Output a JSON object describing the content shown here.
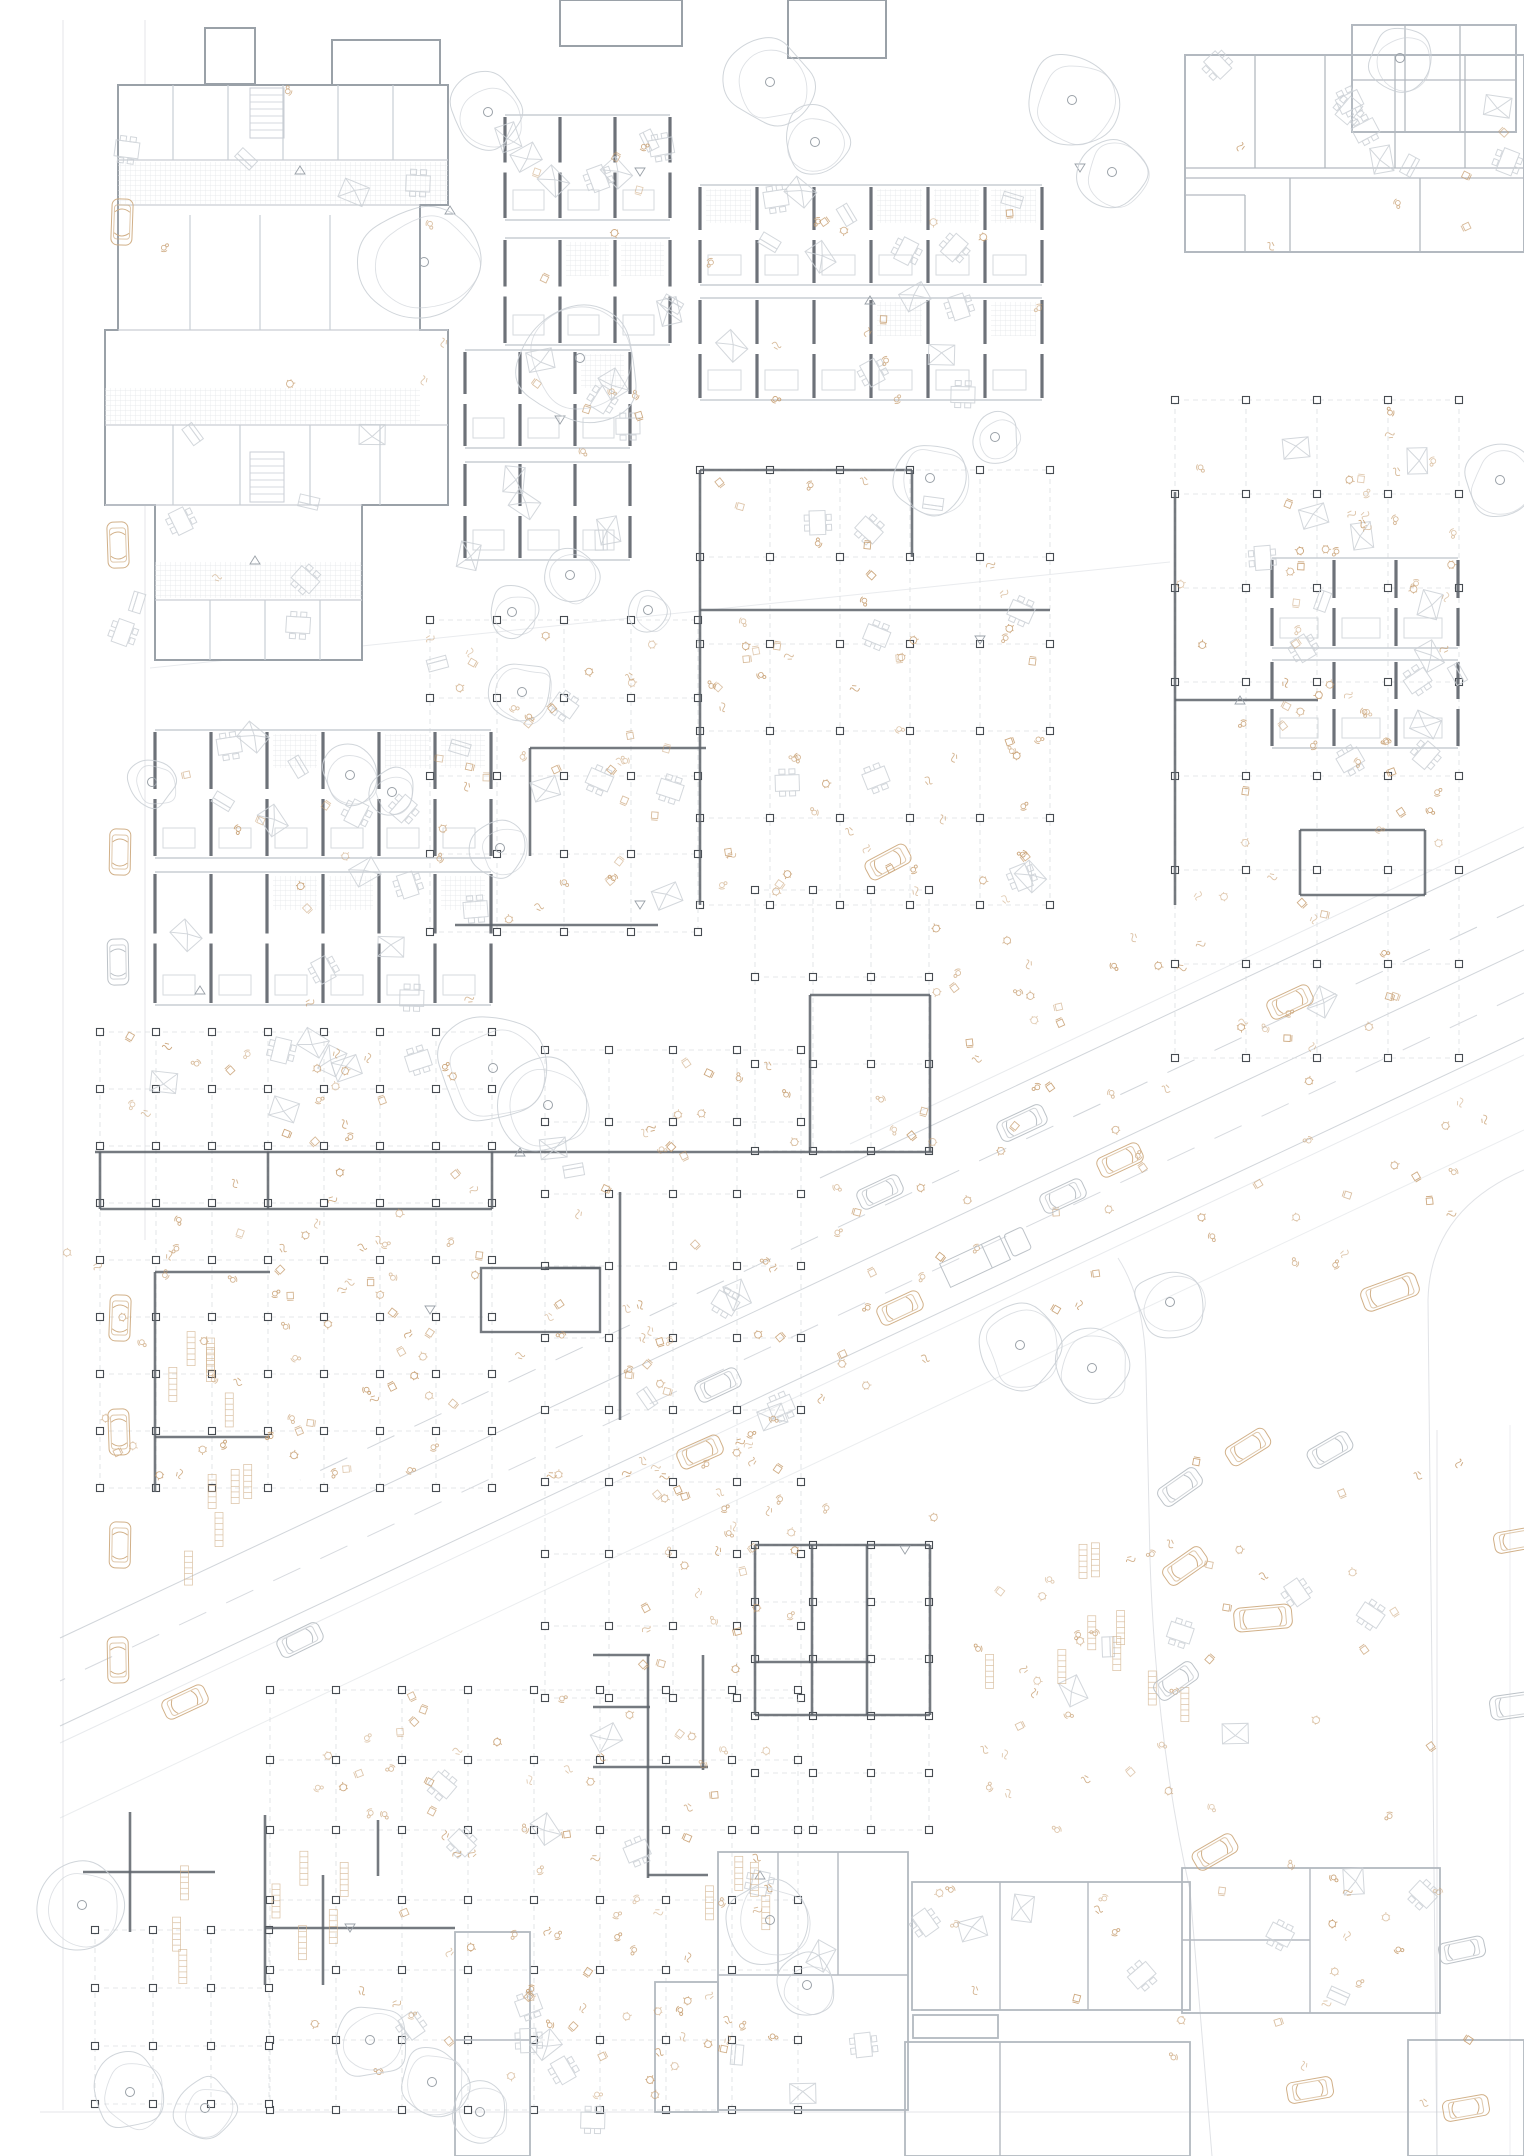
{
  "canvas": {
    "w": 1524,
    "h": 2156,
    "bg": "#ffffff"
  },
  "colors": {
    "wall_light": "#b3b9c0",
    "wall_mid": "#9aa1a8",
    "wall_dark": "#5d636a",
    "column": "#474c52",
    "line_light": "#c9ced4",
    "grid_dash": "#d8dbdf",
    "hatch": "#e2e5e9",
    "tree": "#cbd0d6",
    "beige": "#c69c6d",
    "beige_light": "#d1b18b",
    "car_tan": "#cfac82",
    "car_gray": "#b9bfc5",
    "road": "#c6cbd1",
    "furn_gray": "#ccd1d6"
  },
  "seed": 7,
  "faint_lines": [
    [
      63,
      20,
      63,
      2110,
      0.5
    ],
    [
      145,
      20,
      145,
      1240,
      0.5
    ],
    [
      40,
      2112,
      1460,
      2112,
      0.5
    ],
    [
      150,
      668,
      1170,
      562,
      0.4
    ],
    [
      1437,
      1430,
      1437,
      2156,
      0.5
    ],
    [
      1510,
      1425,
      1510,
      2156,
      0.35
    ]
  ],
  "road_lines": [
    [
      1524,
      827,
      850,
      1144,
      "solid",
      0.4
    ],
    [
      1524,
      847,
      820,
      1178,
      "solid",
      0.8
    ],
    [
      1524,
      905,
      300,
      1480,
      "dash",
      0.8
    ],
    [
      1524,
      950,
      60,
      1638,
      "solid",
      0.8
    ],
    [
      1524,
      993,
      60,
      1681,
      "dash",
      0.7
    ],
    [
      1524,
      1038,
      60,
      1726,
      "solid",
      0.8
    ],
    [
      1524,
      1055,
      60,
      1743,
      "solid",
      0.4
    ],
    [
      1524,
      1130,
      60,
      1818,
      "solid",
      0.35
    ]
  ],
  "kerb_paths": [
    "M1118,1258 Q1145,1300 1146,1370 L1150,1560 Q1156,1740 1190,1890 L1212,2156",
    "M1524,1170 Q1430,1210 1428,1300 L1437,2156"
  ],
  "grids": [
    [
      700,
      470,
      5,
      5,
      70,
      87
    ],
    [
      1175,
      400,
      4,
      7,
      71,
      94
    ],
    [
      430,
      620,
      4,
      4,
      67,
      78
    ],
    [
      755,
      890,
      3,
      3,
      58,
      87
    ],
    [
      100,
      1032,
      7,
      8,
      56,
      57
    ],
    [
      545,
      1050,
      4,
      9,
      64,
      72
    ],
    [
      270,
      1690,
      8,
      6,
      66,
      70
    ],
    [
      95,
      1930,
      3,
      3,
      58,
      58
    ],
    [
      755,
      1545,
      3,
      5,
      58,
      57
    ]
  ],
  "wall_segs": [
    [
      700,
      470,
      700,
      905
    ],
    [
      700,
      470,
      912,
      470
    ],
    [
      700,
      610,
      1050,
      610
    ],
    [
      912,
      470,
      912,
      557
    ],
    [
      1175,
      492,
      1175,
      905
    ],
    [
      1300,
      830,
      1425,
      830
    ],
    [
      1300,
      895,
      1425,
      895
    ],
    [
      1300,
      830,
      1300,
      895
    ],
    [
      1425,
      830,
      1425,
      895
    ],
    [
      1175,
      700,
      1318,
      700
    ],
    [
      530,
      748,
      706,
      748
    ],
    [
      530,
      748,
      530,
      856
    ],
    [
      455,
      925,
      658,
      925
    ],
    [
      810,
      995,
      930,
      995
    ],
    [
      810,
      995,
      810,
      1152
    ],
    [
      930,
      995,
      930,
      1152
    ],
    [
      95,
      1152,
      932,
      1152
    ],
    [
      100,
      1209,
      492,
      1209
    ],
    [
      100,
      1152,
      100,
      1209
    ],
    [
      268,
      1152,
      268,
      1209
    ],
    [
      492,
      1152,
      492,
      1209
    ],
    [
      155,
      1272,
      155,
      1492
    ],
    [
      155,
      1272,
      270,
      1272
    ],
    [
      155,
      1437,
      270,
      1437
    ],
    [
      620,
      1192,
      620,
      1420
    ],
    [
      545,
      1268,
      600,
      1268
    ],
    [
      593,
      1655,
      650,
      1655
    ],
    [
      593,
      1707,
      650,
      1707
    ],
    [
      648,
      1655,
      648,
      1878
    ],
    [
      703,
      1655,
      703,
      1770
    ],
    [
      593,
      1767,
      708,
      1767
    ],
    [
      648,
      1875,
      708,
      1875
    ],
    [
      755,
      1545,
      930,
      1545
    ],
    [
      755,
      1545,
      755,
      1715
    ],
    [
      930,
      1545,
      930,
      1715
    ],
    [
      755,
      1715,
      930,
      1715
    ],
    [
      812,
      1545,
      812,
      1715
    ],
    [
      867,
      1545,
      867,
      1715
    ],
    [
      755,
      1662,
      870,
      1662
    ],
    [
      265,
      1815,
      265,
      1985
    ],
    [
      265,
      1928,
      455,
      1928
    ],
    [
      323,
      1875,
      323,
      1985
    ],
    [
      378,
      1820,
      378,
      1876
    ],
    [
      83,
      1872,
      215,
      1872
    ],
    [
      130,
      1812,
      130,
      1932
    ]
  ],
  "wall_rects": [
    [
      481,
      1268,
      119,
      64
    ]
  ],
  "outbuildings": [
    [
      205,
      28,
      50,
      56
    ],
    [
      332,
      40,
      108,
      52
    ],
    [
      560,
      0,
      122,
      46
    ],
    [
      788,
      0,
      98,
      58
    ]
  ],
  "complex": {
    "path": "M118,85 L448,85 L448,205 L420,205 L420,330 L448,330 L448,505 L362,505 L362,660 L155,660 L155,505 L105,505 L105,330 L118,330 Z",
    "segs": [
      [
        118,
        160,
        448,
        160
      ],
      [
        118,
        205,
        420,
        205
      ],
      [
        118,
        330,
        448,
        330
      ],
      [
        105,
        425,
        448,
        425
      ],
      [
        105,
        505,
        362,
        505
      ],
      [
        155,
        600,
        362,
        600
      ],
      [
        173,
        85,
        173,
        160
      ],
      [
        228,
        85,
        228,
        160
      ],
      [
        283,
        85,
        283,
        160
      ],
      [
        338,
        85,
        338,
        160
      ],
      [
        393,
        85,
        393,
        160
      ],
      [
        190,
        215,
        190,
        330
      ],
      [
        260,
        215,
        260,
        330
      ],
      [
        330,
        215,
        330,
        330
      ],
      [
        173,
        425,
        173,
        505
      ],
      [
        240,
        425,
        240,
        505
      ],
      [
        310,
        425,
        310,
        505
      ],
      [
        380,
        425,
        380,
        505
      ],
      [
        210,
        600,
        210,
        660
      ],
      [
        265,
        600,
        265,
        660
      ],
      [
        320,
        600,
        320,
        660
      ]
    ],
    "hatch": [
      [
        118,
        162,
        330,
        42
      ],
      [
        105,
        388,
        315,
        36
      ],
      [
        155,
        562,
        207,
        36
      ]
    ],
    "stairs": [
      [
        250,
        88
      ],
      [
        250,
        452
      ]
    ]
  },
  "corridor_buildings": [
    {
      "rect": [
        1185,
        55,
        339,
        197
      ],
      "segs": [
        [
          1185,
          168,
          1524,
          168
        ],
        [
          1185,
          178,
          1524,
          178
        ],
        [
          1255,
          55,
          1255,
          168
        ],
        [
          1325,
          55,
          1325,
          168
        ],
        [
          1395,
          55,
          1395,
          168
        ],
        [
          1465,
          55,
          1465,
          168
        ],
        [
          1290,
          178,
          1290,
          252
        ],
        [
          1420,
          178,
          1420,
          252
        ],
        [
          1185,
          195,
          1245,
          195
        ],
        [
          1245,
          195,
          1245,
          252
        ]
      ]
    },
    {
      "rect": [
        1352,
        25,
        164,
        107
      ],
      "segs": [
        [
          1405,
          25,
          1405,
          132
        ],
        [
          1460,
          25,
          1460,
          132
        ],
        [
          1352,
          80,
          1516,
          80
        ]
      ]
    }
  ],
  "outline_buildings": [
    {
      "rect": [
        718,
        1852,
        190,
        258
      ],
      "segs": [
        [
          778,
          1852,
          778,
          1975
        ],
        [
          838,
          1852,
          838,
          1975
        ],
        [
          718,
          1975,
          908,
          1975
        ]
      ]
    },
    {
      "rect": [
        655,
        1982,
        63,
        130
      ],
      "segs": []
    },
    {
      "rect": [
        912,
        1882,
        278,
        128
      ],
      "segs": [
        [
          1000,
          1882,
          1000,
          2010
        ],
        [
          1088,
          1882,
          1088,
          2010
        ]
      ]
    },
    {
      "rect": [
        1182,
        1868,
        258,
        145
      ],
      "segs": [
        [
          1310,
          1868,
          1310,
          2013
        ],
        [
          1182,
          1940,
          1310,
          1940
        ]
      ]
    },
    {
      "rect": [
        905,
        2042,
        285,
        114
      ],
      "segs": [
        [
          1000,
          2042,
          1000,
          2156
        ]
      ]
    },
    {
      "rect": [
        1408,
        2040,
        116,
        116
      ],
      "segs": []
    },
    {
      "rect": [
        455,
        1932,
        75,
        224
      ],
      "segs": [
        [
          455,
          2040,
          530,
          2040
        ]
      ]
    },
    {
      "rect": [
        913,
        2015,
        85,
        23
      ],
      "segs": []
    }
  ],
  "slab_clusters": [
    {
      "x": 505,
      "y": 115,
      "units": 3,
      "uw": 55,
      "bands": [
        [
          115,
          105
        ],
        [
          238,
          107
        ]
      ]
    },
    {
      "x": 465,
      "y": 350,
      "units": 3,
      "uw": 55,
      "bands": [
        [
          350,
          98
        ],
        [
          462,
          98
        ]
      ]
    },
    {
      "x": 700,
      "y": 185,
      "units": 6,
      "uw": 57,
      "bands": [
        [
          185,
          100
        ],
        [
          298,
          102
        ]
      ]
    },
    {
      "x": 155,
      "y": 730,
      "units": 6,
      "uw": 56,
      "bands": [
        [
          730,
          128
        ],
        [
          872,
          133
        ]
      ]
    },
    {
      "x": 1272,
      "y": 558,
      "units": 3,
      "uw": 62,
      "bands": [
        [
          558,
          90
        ],
        [
          660,
          88
        ]
      ]
    }
  ],
  "trees": [
    [
      488,
      112,
      40
    ],
    [
      424,
      262,
      62
    ],
    [
      580,
      358,
      66
    ],
    [
      770,
      82,
      46
    ],
    [
      815,
      142,
      36
    ],
    [
      1072,
      100,
      48
    ],
    [
      1112,
      172,
      38
    ],
    [
      1400,
      58,
      34
    ],
    [
      930,
      478,
      40
    ],
    [
      995,
      437,
      26
    ],
    [
      1500,
      480,
      40
    ],
    [
      570,
      575,
      30
    ],
    [
      512,
      612,
      26
    ],
    [
      522,
      692,
      34
    ],
    [
      152,
      782,
      26
    ],
    [
      350,
      775,
      30
    ],
    [
      392,
      792,
      24
    ],
    [
      500,
      848,
      30
    ],
    [
      493,
      1068,
      56
    ],
    [
      548,
      1105,
      50
    ],
    [
      1020,
      1345,
      46
    ],
    [
      1092,
      1368,
      42
    ],
    [
      1170,
      1302,
      38
    ],
    [
      770,
      1920,
      46
    ],
    [
      807,
      1985,
      32
    ],
    [
      82,
      1905,
      44
    ],
    [
      370,
      2040,
      40
    ],
    [
      432,
      2082,
      36
    ],
    [
      480,
      2112,
      30
    ],
    [
      130,
      2092,
      40
    ],
    [
      205,
      2108,
      32
    ],
    [
      648,
      610,
      22
    ]
  ],
  "cars": [
    [
      122,
      222,
      2,
      "tan",
      "car"
    ],
    [
      118,
      545,
      -2,
      "tan",
      "car"
    ],
    [
      120,
      852,
      1,
      "tan",
      "car"
    ],
    [
      118,
      962,
      -1,
      "gray",
      "car"
    ],
    [
      120,
      1318,
      2,
      "tan",
      "car"
    ],
    [
      119,
      1432,
      -2,
      "tan",
      "car"
    ],
    [
      120,
      1545,
      1,
      "tan",
      "car"
    ],
    [
      118,
      1660,
      -1,
      "tan",
      "car"
    ],
    [
      1022,
      1123,
      65,
      "gray",
      "suv"
    ],
    [
      1290,
      1002,
      65,
      "tan",
      "car"
    ],
    [
      880,
      1192,
      65,
      "gray",
      "car"
    ],
    [
      1120,
      1160,
      65,
      "tan",
      "car"
    ],
    [
      1063,
      1196,
      65,
      "gray",
      "car"
    ],
    [
      985,
      1257,
      65,
      "gray",
      "truck"
    ],
    [
      900,
      1308,
      65,
      "tan",
      "car"
    ],
    [
      718,
      1385,
      65,
      "gray",
      "car"
    ],
    [
      700,
      1452,
      66,
      "tan",
      "car"
    ],
    [
      300,
      1640,
      64,
      "gray",
      "car"
    ],
    [
      185,
      1702,
      65,
      "tan",
      "car"
    ],
    [
      888,
      862,
      62,
      "tan",
      "car"
    ],
    [
      1390,
      1292,
      70,
      "tan",
      "van"
    ],
    [
      1248,
      1447,
      58,
      "tan",
      "car"
    ],
    [
      1330,
      1450,
      60,
      "gray",
      "car"
    ],
    [
      1180,
      1487,
      55,
      "gray",
      "car"
    ],
    [
      1185,
      1566,
      55,
      "tan",
      "car"
    ],
    [
      1263,
      1618,
      85,
      "tan",
      "van"
    ],
    [
      1176,
      1681,
      55,
      "gray",
      "car"
    ],
    [
      1517,
      1540,
      80,
      "tan",
      "car"
    ],
    [
      1519,
      1705,
      82,
      "gray",
      "van"
    ],
    [
      1215,
      1852,
      60,
      "tan",
      "car"
    ],
    [
      1310,
      2090,
      80,
      "tan",
      "car"
    ],
    [
      1462,
      1950,
      78,
      "gray",
      "car"
    ],
    [
      1466,
      2108,
      80,
      "tan",
      "car"
    ]
  ],
  "scatter_beige": [
    [
      700,
      480,
      345,
      420,
      55
    ],
    [
      1180,
      410,
      275,
      640,
      60
    ],
    [
      435,
      628,
      262,
      295,
      32
    ],
    [
      100,
      1035,
      390,
      110,
      20
    ],
    [
      95,
      1230,
      395,
      255,
      45
    ],
    [
      545,
      1058,
      252,
      495,
      40
    ],
    [
      270,
      1695,
      525,
      395,
      65
    ],
    [
      640,
      1545,
      160,
      140,
      15
    ],
    [
      935,
      905,
      235,
      185,
      18
    ],
    [
      60,
      1165,
      480,
      330,
      22
    ],
    [
      1150,
      1455,
      320,
      660,
      26
    ],
    [
      620,
      1302,
      330,
      250,
      28
    ],
    [
      835,
      1065,
      325,
      245,
      26
    ],
    [
      1200,
      1065,
      320,
      215,
      18
    ],
    [
      918,
      1888,
      265,
      115,
      8
    ],
    [
      1190,
      1875,
      245,
      135,
      8
    ],
    [
      430,
      1935,
      370,
      180,
      20
    ],
    [
      975,
      1545,
      240,
      300,
      25
    ],
    [
      505,
      120,
      170,
      430,
      12
    ],
    [
      705,
      190,
      340,
      215,
      14
    ],
    [
      160,
      735,
      335,
      275,
      10
    ],
    [
      1275,
      560,
      190,
      190,
      10
    ],
    [
      120,
      90,
      330,
      565,
      8
    ],
    [
      1190,
      60,
      330,
      195,
      6
    ]
  ],
  "scatter_gray": [
    [
      300,
      1992,
      320,
      140,
      6
    ],
    [
      1060,
      1585,
      380,
      155,
      6
    ],
    [
      430,
      1705,
      255,
      165,
      5
    ],
    [
      548,
      1062,
      248,
      410,
      7
    ],
    [
      702,
      482,
      338,
      400,
      9
    ],
    [
      1182,
      412,
      268,
      630,
      9
    ],
    [
      102,
      1042,
      380,
      100,
      7
    ],
    [
      437,
      632,
      258,
      285,
      7
    ],
    [
      1274,
      562,
      188,
      186,
      6
    ],
    [
      157,
      737,
      332,
      268,
      14
    ],
    [
      507,
      122,
      166,
      222,
      9
    ],
    [
      467,
      357,
      196,
      200,
      9
    ],
    [
      702,
      192,
      340,
      208,
      14
    ],
    [
      120,
      95,
      326,
      555,
      12
    ],
    [
      1190,
      62,
      328,
      188,
      8
    ],
    [
      915,
      1888,
      270,
      115,
      4
    ],
    [
      1185,
      1872,
      252,
      138,
      4
    ],
    [
      720,
      1860,
      180,
      240,
      5
    ]
  ],
  "shelves": [
    [
      165,
      1340,
      100,
      265,
      10
    ],
    [
      985,
      1552,
      225,
      160,
      9
    ],
    [
      272,
      1842,
      118,
      118,
      5
    ],
    [
      632,
      1872,
      150,
      55,
      4
    ],
    [
      168,
      1878,
      28,
      90,
      3
    ]
  ],
  "tri_marks": [
    [
      300,
      170,
      1
    ],
    [
      640,
      172,
      -1
    ],
    [
      870,
      300,
      1
    ],
    [
      1080,
      168,
      -1
    ],
    [
      255,
      560,
      1
    ],
    [
      640,
      905,
      -1
    ],
    [
      520,
      1152,
      1
    ],
    [
      905,
      1550,
      -1
    ],
    [
      760,
      1875,
      1
    ],
    [
      350,
      1928,
      -1
    ],
    [
      450,
      210,
      1
    ],
    [
      980,
      640,
      -1
    ],
    [
      1240,
      700,
      1
    ],
    [
      560,
      420,
      -1
    ],
    [
      200,
      990,
      1
    ],
    [
      430,
      1310,
      -1
    ]
  ]
}
